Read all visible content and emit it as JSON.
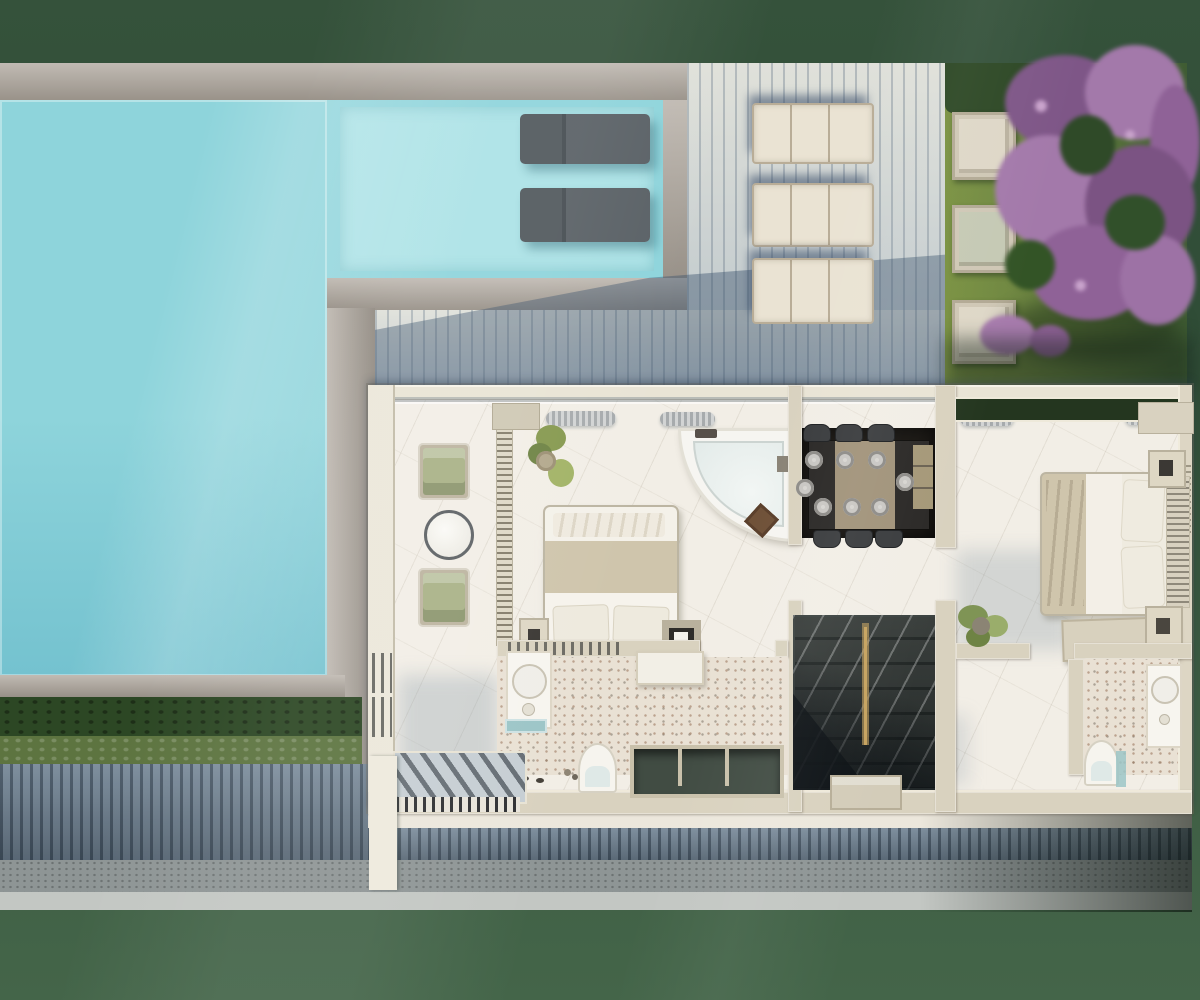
{
  "scene": {
    "type": "3d-architectural-render",
    "view": "top-down-floor-plan",
    "areas": [
      "swimming-pool",
      "pool-tanning-shelf",
      "wooden-deck",
      "garden-lawn",
      "flowering-tree",
      "terrace-lounge",
      "bedroom-one",
      "corner-bathtub",
      "dining-area",
      "staircase",
      "bathroom-one",
      "hallway",
      "master-bedroom",
      "master-bathroom",
      "hedge-rows",
      "plank-fence",
      "gravel-path",
      "entrance-canopy"
    ],
    "counts": {
      "in_pool_loungers": 2,
      "deck_loungers": 3,
      "garden_pavers": 3,
      "green_armchairs": 2,
      "dining_place_settings": 8,
      "dining_chairs": 8,
      "beds": 2,
      "toilets": 2,
      "sinks": 2,
      "bathtubs": 1,
      "potted_plants": 3
    }
  },
  "palette": {
    "bgTop": "#35523b",
    "bgBot": "#446549",
    "pool": "#8ed4db",
    "shelf": "#abe2e6",
    "poolDeep": "#74c2cf",
    "stone": "#aca49a",
    "deck": "#ccd1d0",
    "grass": "#6f8742",
    "hedge": "#2c4724",
    "hedgeL": "#5d7440",
    "fence": "#64788a",
    "gravel": "#8e9595",
    "path": "#c3c7c3",
    "wall": "#d9d2bf",
    "wallL": "#ece7da",
    "marble": "#f2eee6",
    "terr": "#e9e1d4",
    "chairG": "#a9b287",
    "frame": "#bcb49f",
    "duvet": "#cfc5ac",
    "whiteLinen": "#f4f1e9",
    "dining": "#181511",
    "wood": "#a1937a",
    "chairD": "#3a3c3e",
    "plate": "#d7d5d1",
    "stairs": "#6d7270",
    "gold": "#c6a360",
    "trough": "#414c43",
    "teal": "#9cc5c7",
    "purple1": "#7e5687",
    "purple2": "#a379aa",
    "purple3": "#8f6297",
    "treeGap": "#2f4a28",
    "plantGreen": "#86994f",
    "loungerC": "#eae3d3",
    "slate": "#596065",
    "canopy": "#c6ced3"
  }
}
